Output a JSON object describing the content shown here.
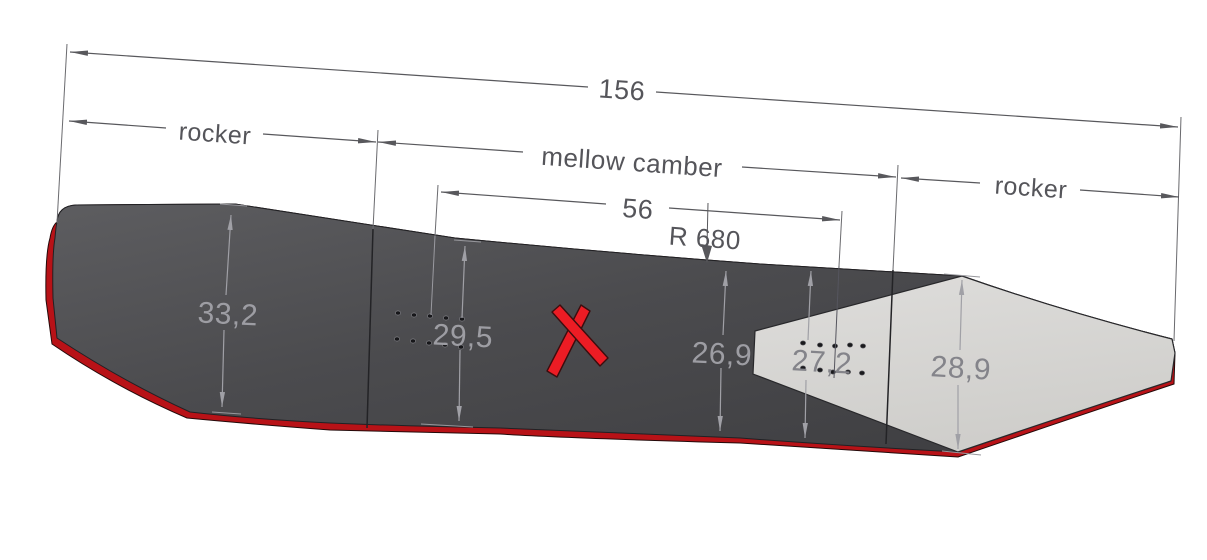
{
  "diagram": {
    "overall_length": "156",
    "zones": {
      "rocker_left": "rocker",
      "camber": "mellow camber",
      "rocker_right": "rocker"
    },
    "stance_width": "56",
    "sidecut_radius": "R 680",
    "widths": {
      "nose": "33,2",
      "front_inserts": "29,5",
      "waist": "26,9",
      "rear_inserts": "27,2",
      "tail": "28,9"
    },
    "colors": {
      "base_edge_red": "#b81217",
      "topsheet_dark": "#4a4a4d",
      "tail_panel_light": "#d7d6d3",
      "dimension_gray": "#58585c",
      "onboard_gray": "#a0a0a6",
      "logo_red": "#ec1c24"
    }
  }
}
